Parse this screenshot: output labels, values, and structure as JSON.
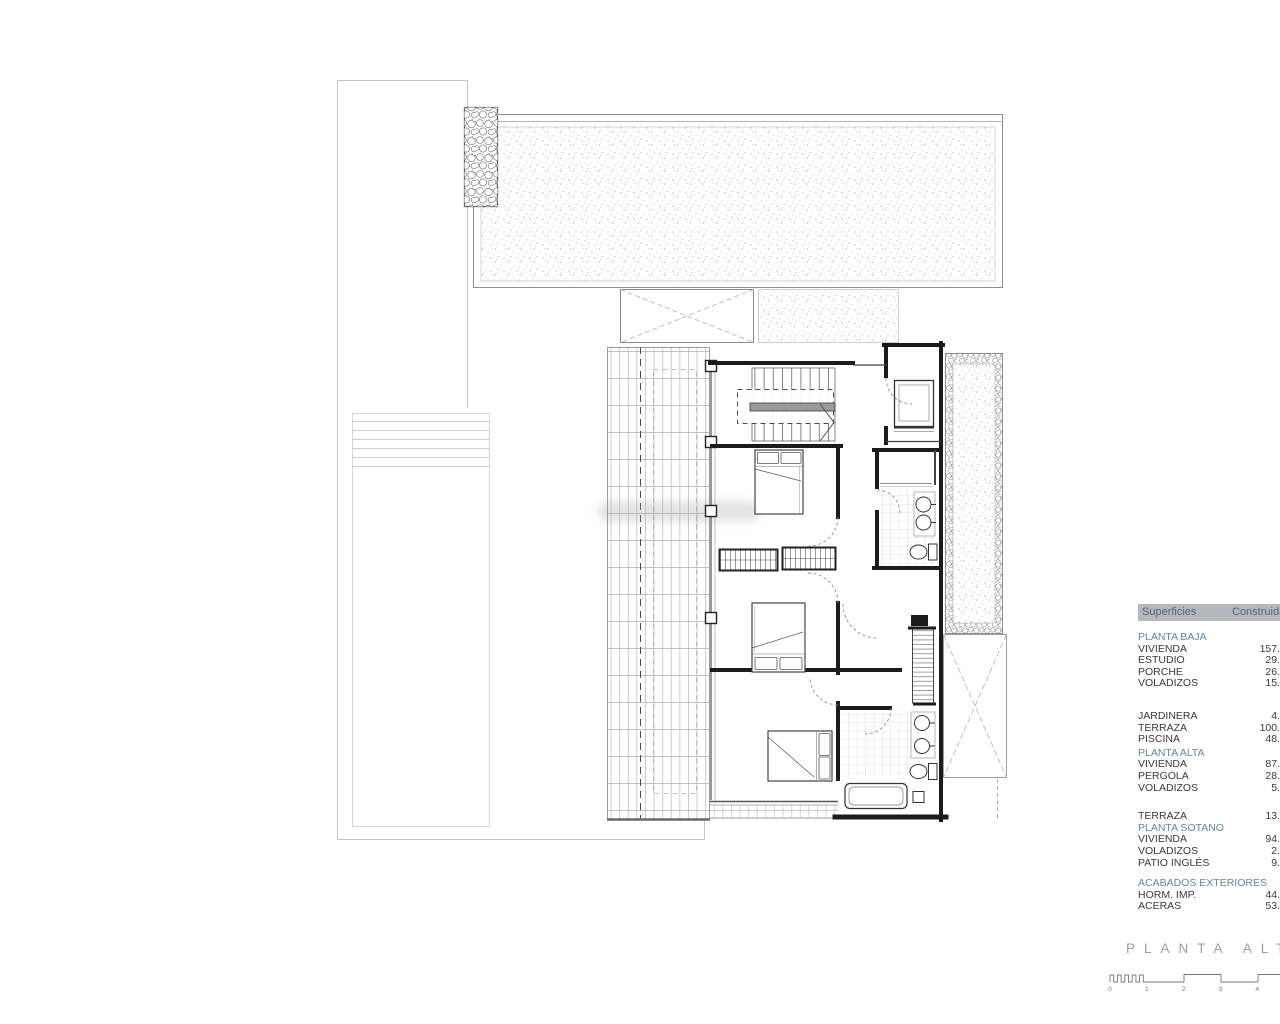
{
  "title": {
    "text": "PLANTA ALTA"
  },
  "table": {
    "header": {
      "col_surfaces": "Superficies",
      "col_built": "Construida"
    },
    "sections": [
      {
        "id": "planta-baja",
        "header": "PLANTA BAJA",
        "rows": [
          [
            "VIVIENDA",
            "157."
          ],
          [
            "ESTUDIO",
            "29."
          ],
          [
            "PORCHE",
            "26."
          ],
          [
            "VOLADIZOS",
            "15."
          ]
        ]
      },
      {
        "id": "exterior-baja",
        "header": null,
        "rows": [
          [
            "JARDINERA",
            "4."
          ],
          [
            "TERRAZA",
            "100."
          ],
          [
            "PISCINA",
            "48."
          ]
        ]
      },
      {
        "id": "planta-alta",
        "header": "PLANTA ALTA",
        "rows": [
          [
            "VIVIENDA",
            "87."
          ],
          [
            "PERGOLA",
            "28."
          ],
          [
            "VOLADIZOS",
            "5."
          ]
        ]
      },
      {
        "id": "terraza-alta",
        "header": null,
        "rows": [
          [
            "TERRAZA",
            "13."
          ]
        ]
      },
      {
        "id": "planta-sotano",
        "header": "PLANTA SOTANO",
        "rows": [
          [
            "VIVIENDA",
            "94."
          ],
          [
            "VOLADIZOS",
            "2."
          ],
          [
            "PATIO INGLÉS",
            "9."
          ]
        ]
      },
      {
        "id": "acabados",
        "header": "ACABADOS EXTERIORES",
        "rows": [
          [
            "HORM. IMP.",
            "44."
          ],
          [
            "ACERAS",
            "53."
          ]
        ]
      }
    ]
  },
  "scale_bar": {
    "ticks": [
      "0",
      "1",
      "2",
      "3",
      "4"
    ]
  },
  "colors": {
    "accent_blue": "#5f88a2",
    "table_header_bg": "#b4b8bc",
    "table_header_text": "#51657f",
    "wall_dark": "#1b1b1b",
    "line_gray": "#8f8f8f",
    "title_gray": "#9b9fa3"
  }
}
